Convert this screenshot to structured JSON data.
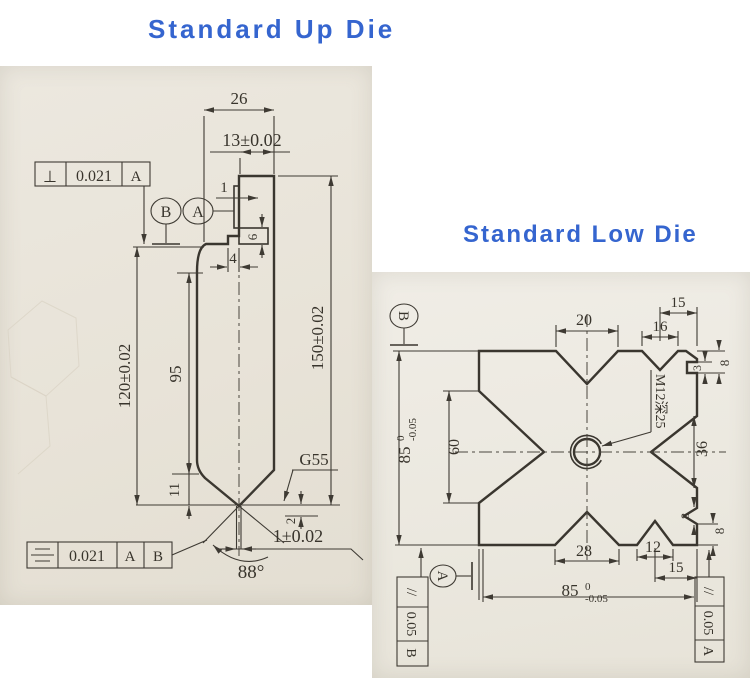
{
  "titles": {
    "up": "Standard Up Die",
    "low": "Standard Low Die"
  },
  "colors": {
    "title_blue": "#3565cf",
    "line": "#3a362f",
    "paper_up": "#e9e4da",
    "paper_low": "#edebe3"
  },
  "up_die": {
    "dim_26": "26",
    "dim_13": "13±0.02",
    "dim_1": "1",
    "dim_6": "6",
    "dim_4": "4",
    "dim_120": "120±0.02",
    "dim_95": "95",
    "dim_150": "150±0.02",
    "dim_11": "11",
    "dim_2": "2",
    "dim_tip": "1±0.02",
    "angle": "88°",
    "note_g55": "G55",
    "datum_b": "B",
    "datum_a": "A",
    "fcf_top": {
      "symbol": "⊥",
      "tol": "0.021",
      "datum": "A"
    },
    "fcf_bottom": {
      "symbol_name": "symmetry",
      "tol": "0.021",
      "datum_a": "A",
      "datum_b": "B"
    }
  },
  "low_die": {
    "dim_20": "20",
    "dim_16": "16",
    "dim_15_top": "15",
    "dim_3": "3",
    "dim_8_top": "8",
    "dim_60": "60",
    "dim_36": "36",
    "note_thread": "M12深25",
    "dim_28": "28",
    "dim_12": "12",
    "dim_15_bottom": "15",
    "dim_8_mid": "8",
    "dim_8_low": "8",
    "dim_85_left": {
      "value": "85",
      "tol_top": "0",
      "tol_bottom": "-0.05"
    },
    "dim_85_bottom": {
      "value": "85",
      "tol_top": "0",
      "tol_bottom": "-0.05"
    },
    "datum_b": "B",
    "datum_a": "A",
    "fcf_left": {
      "symbol": "//",
      "tol": "0.05",
      "datum": "B"
    },
    "fcf_right": {
      "symbol": "//",
      "tol": "0.05",
      "datum": "A"
    }
  }
}
